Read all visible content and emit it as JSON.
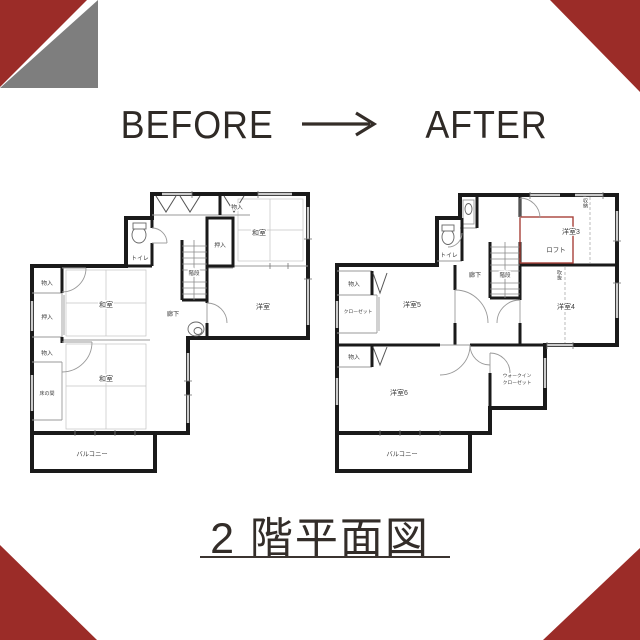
{
  "header": {
    "before_label": "BEFORE",
    "after_label": "AFTER",
    "arrow_icon": "right-arrow"
  },
  "footer": {
    "title": "2 階平面図"
  },
  "colors": {
    "accent_red": "#9b2c28",
    "corner_gray": "#7e7e7e",
    "loft_red": "#a8423a",
    "wall_black": "#1a1a1a",
    "text_dark": "#2f2a26"
  },
  "plans": {
    "before": {
      "labels": {
        "toilet": "トイレ",
        "entry_storage": "物入",
        "oshiire_top": "押入",
        "washitsu_top": "和室",
        "stairs": "階段",
        "yoshitsu": "洋室",
        "corridor": "廊下",
        "monoire_left": "物入",
        "oshiire_left": "押入",
        "washitsu_mid": "和室",
        "monoire_lower": "物入",
        "tokonoma": "床の間",
        "washitsu_bottom": "和室",
        "balcony": "バルコニー"
      }
    },
    "after": {
      "labels": {
        "toilet": "トイレ",
        "corridor": "廊下",
        "stairs": "階段",
        "room3": "洋室3",
        "loft": "ロフト",
        "storage_note": "収納",
        "room4": "洋室4",
        "void_note": "吹抜",
        "monoire_left": "物入",
        "closet": "クローゼット",
        "room5": "洋室5",
        "monoire_lower": "物入",
        "room6": "洋室6",
        "wic_line1": "ウォークイン",
        "wic_line2": "クローゼット",
        "balcony": "バルコニー"
      }
    }
  }
}
